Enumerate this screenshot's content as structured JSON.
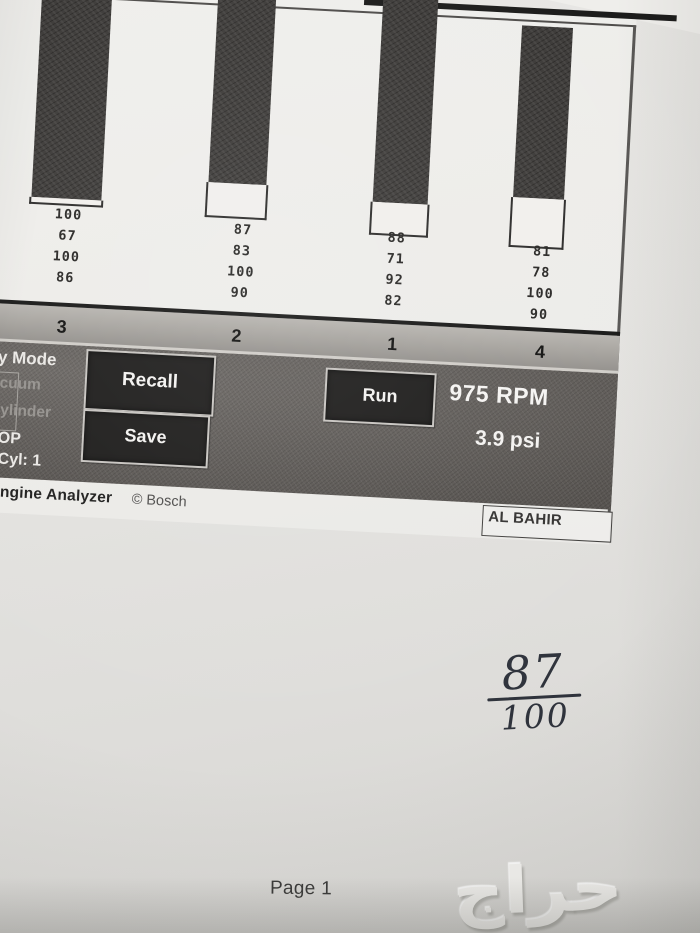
{
  "photo": {
    "page_footer": "Page 1",
    "watermark_text": "حراج",
    "handwritten_score": {
      "numerator": "87",
      "denominator": "100"
    }
  },
  "report": {
    "toolbar": {
      "mode_label": "y Mode",
      "option_vacuum": "cuum",
      "option_cylinder": "ylinder",
      "status_op": "OP",
      "status_cyl": "Cyl: 1",
      "recall_label": "Recall",
      "save_label": "Save",
      "run_label": "Run",
      "rpm_readout": "975 RPM",
      "pressure_readout": "3.9 psi"
    },
    "branding": {
      "app_name": "ngine Analyzer",
      "copyright": "© Bosch"
    },
    "stamp": "AL BAHIR"
  },
  "chart_data": {
    "type": "bar",
    "orientation": "vertical, bars hang from top frame",
    "title": "",
    "categories": [
      "3",
      "2",
      "1",
      "4"
    ],
    "bar_fill_values": [
      100,
      87,
      88,
      81
    ],
    "series": [
      {
        "name": "row-1",
        "values": [
          100,
          87,
          88,
          81
        ]
      },
      {
        "name": "row-2",
        "values": [
          67,
          83,
          71,
          78
        ]
      },
      {
        "name": "row-3",
        "values": [
          100,
          100,
          92,
          100
        ]
      },
      {
        "name": "row-4",
        "values": [
          86,
          90,
          82,
          90
        ]
      }
    ],
    "ylim": [
      0,
      100
    ],
    "legend": "none",
    "note": "dark fill length = row-1 value; outlined white segment = remainder to 100"
  },
  "colors": {
    "paper": "#e4e3e0",
    "bar_fill": "#343230",
    "bar_remainder": "#f1efec",
    "cylinder_band": "#a5a29d",
    "toolbar": "#5b5753",
    "button_bg": "#1c1b1a",
    "button_border": "#c7c4c0",
    "ink_handwriting": "#2f333c"
  }
}
